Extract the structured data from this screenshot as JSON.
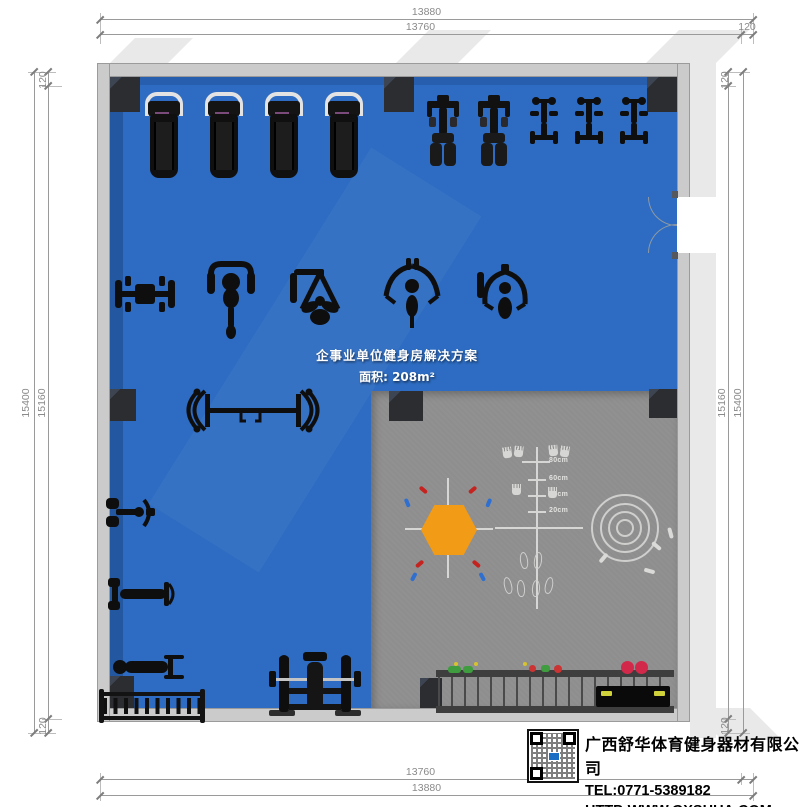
{
  "plan_labels": {
    "title": "企事业单位健身房解决方案",
    "area": "面积: 208m²"
  },
  "dimensions": {
    "top": {
      "outer": "13880",
      "inner": "13760",
      "wall": "120"
    },
    "bottom": {
      "inner": "13760",
      "outer": "13880"
    },
    "left": {
      "wall_top": "120",
      "outer": "15400",
      "inner": "15160",
      "wall_bottom": "120"
    },
    "right": {
      "wall_top": "120",
      "inner": "15160",
      "outer": "15400",
      "wall_bottom": "120"
    }
  },
  "functional_zone": {
    "ruler_labels": [
      "80cm",
      "60cm",
      "40cm",
      "20cm"
    ]
  },
  "company": {
    "name": "广西舒华体育健身器材有限公司",
    "tel": "TEL:0771-5389182",
    "website": "HTTP:WWW.GXSHUA.COM"
  },
  "equipment": {
    "items": [
      "treadmill",
      "recumbent-bike",
      "upright-trainer",
      "seated-row-machine",
      "lat-pulldown-machine",
      "pec-deck-machine",
      "cable-arm-machine",
      "multi-press-machine",
      "cable-crossover",
      "leg-curl-machine",
      "adjustable-bench",
      "flat-bench",
      "dumbbell-rack",
      "bench-press-rack",
      "accessory-storage-rack"
    ],
    "treadmill_count": 4,
    "recumbent_bike_count": 2,
    "upright_trainer_count": 3
  },
  "colors": {
    "floor-blue": "#2d6cc2",
    "zone-gray": "#8e8e8e",
    "wall-gray": "#cbcbcb",
    "column-dark": "#2b2d31",
    "equipment-black": "#0e0e0e",
    "hex-orange": "#f29b16",
    "mark-red": "#c4231f",
    "mark-blue": "#2f6fd0",
    "dim-line": "#9a9a9a",
    "dim-text": "#8a8a8a",
    "marking-white": "#d6d6d4"
  }
}
